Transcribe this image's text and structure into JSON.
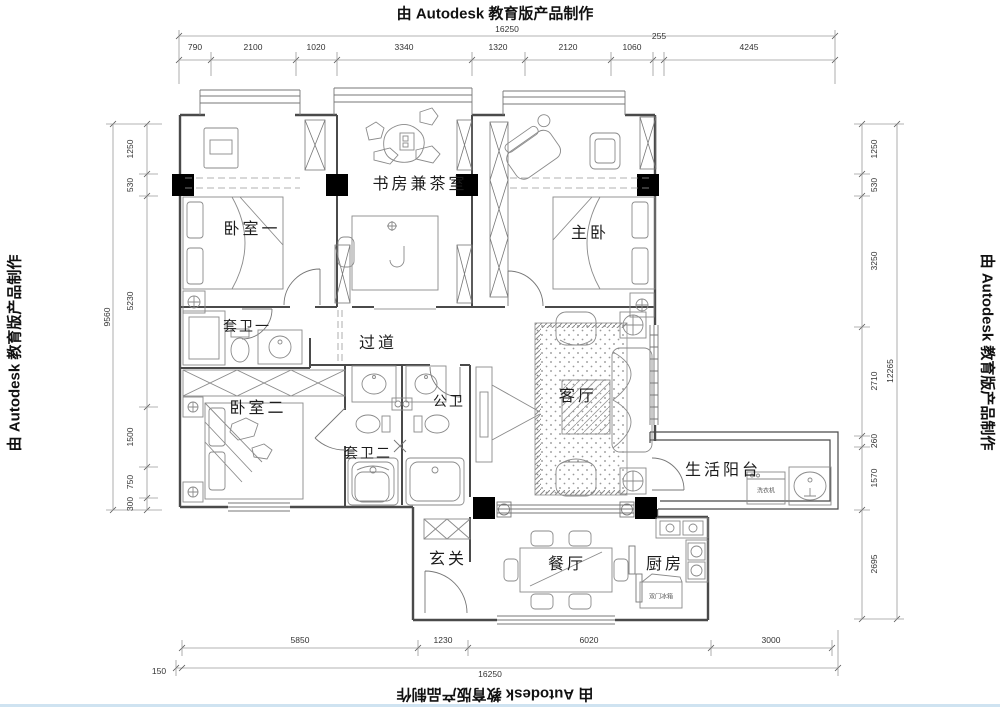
{
  "watermarks": {
    "top": "由 Autodesk 教育版产品制作",
    "bottom": "由 Autodesk 教育版产品制作",
    "left": "由 Autodesk 教育版产品制作",
    "right": "由 Autodesk 教育版产品制作"
  },
  "rooms": {
    "bedroom1": {
      "label": "卧室一"
    },
    "study": {
      "label": "书房兼茶室"
    },
    "master": {
      "label": "主卧"
    },
    "ensuite1": {
      "label": "套卫一"
    },
    "corridor": {
      "label": "过道"
    },
    "bedroom2": {
      "label": "卧室二"
    },
    "public_bath": {
      "label": "公卫"
    },
    "ensuite2": {
      "label": "套卫二"
    },
    "living": {
      "label": "客厅"
    },
    "balcony": {
      "label": "生活阳台"
    },
    "entry": {
      "label": "玄关"
    },
    "dining": {
      "label": "餐厅"
    },
    "kitchen": {
      "label": "厨房"
    }
  },
  "appliances": {
    "washer": "洗衣机",
    "fridge": "双门冰箱"
  },
  "dimensions": {
    "top": {
      "total": "16250",
      "segments": [
        "790",
        "2100",
        "1020",
        "3340",
        "1320",
        "2120",
        "1060",
        "255",
        "4245"
      ]
    },
    "left": {
      "total": "9560",
      "segments": [
        "1250",
        "530",
        "5230",
        "1500",
        "750",
        "300"
      ]
    },
    "right": {
      "total": "12265",
      "segments": [
        "1250",
        "530",
        "3250",
        "2710",
        "260",
        "1570",
        "2695"
      ]
    },
    "bottom": {
      "total": "16250",
      "offset": "150",
      "segments": [
        "5850",
        "1230",
        "6020",
        "3000"
      ]
    }
  },
  "colors": {
    "wall": "#4a4a4a",
    "furniture": "#8a8a8a",
    "dimension": "#9a9a9a",
    "column": "#000000",
    "watermark": "#111111",
    "bottom_strip": "#cfe3f1"
  }
}
